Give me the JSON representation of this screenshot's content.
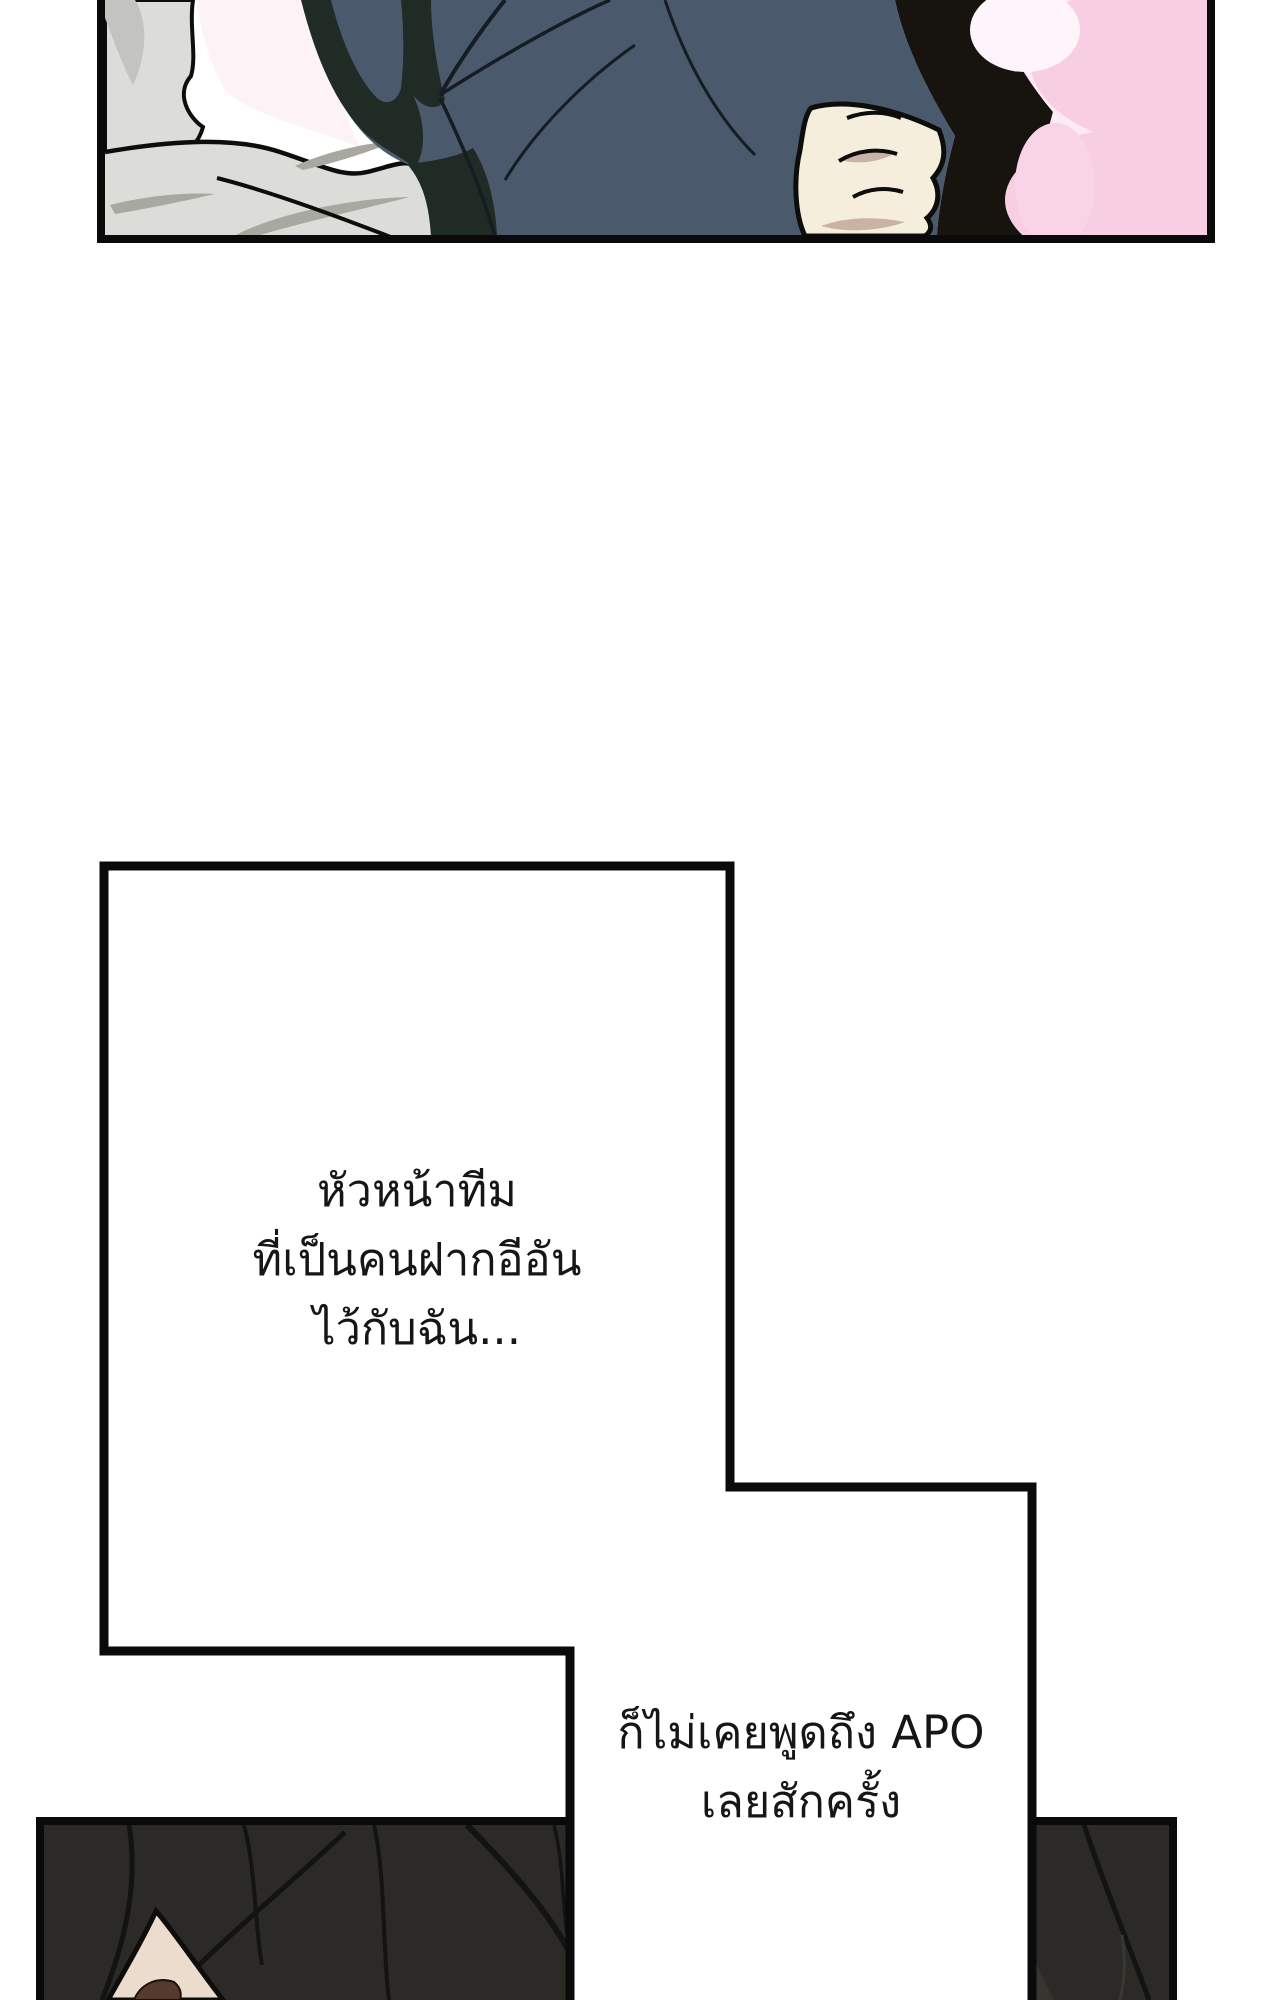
{
  "page": {
    "type": "webtoon-comic-page",
    "background": "#ffffff",
    "panel_border_color": "#0a0a0a"
  },
  "monologues": [
    {
      "lines": [
        "หัวหน้าทีม",
        "ที่เป็นคนฝากอีอัน",
        "ไว้กับฉัน..."
      ]
    },
    {
      "lines": [
        "ก็ไม่เคยพูดถึง APO",
        "เลยสักครั้ง"
      ]
    }
  ],
  "colors": {
    "panel_border": "#0a0a0a",
    "text": "#161616",
    "jacket_navy": "#4a5a6c",
    "jacket_shadow_olive": "#212b25",
    "jacket_edge_black": "#17130f",
    "bedding_gray": "#dcdcd8",
    "bedding_gray_dark": "#c3c3bf",
    "bedding_shade": "#a8a8a0",
    "gap_pale_pink": "#fdf3f7",
    "watercolor_pink_light": "#fdeaf4",
    "watercolor_pink_deep": "#f8cee3",
    "fist_skin": "#f5eedc",
    "fist_shadow": "#c9b3a4",
    "hair_dark": "#2b2a26",
    "hair_strand": "#131311",
    "hair_highlight": "#37352f",
    "face_skin": "#ecdccd",
    "eyebrow_brown": "#553a2e"
  }
}
